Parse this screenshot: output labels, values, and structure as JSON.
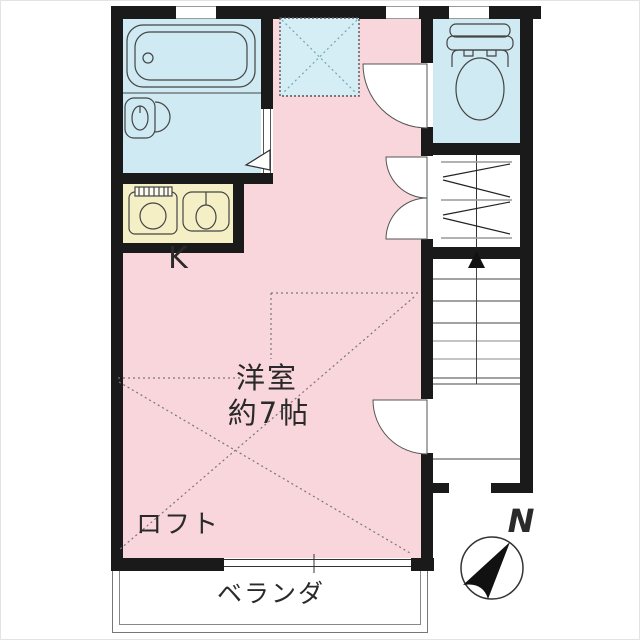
{
  "floorplan": {
    "labels": {
      "kitchen": "K",
      "room_name": "洋室",
      "room_size": "約7帖",
      "loft": "ロフト",
      "veranda": "ベランダ",
      "north": "N"
    },
    "colors": {
      "room_fill": "#f8d6dc",
      "wet_area_fill": "#cfeaf2",
      "kitchen_fill": "#f5efc5",
      "ladder_area_fill": "#d5edf4",
      "wall": "#1a1a1a"
    },
    "icons": [
      "bathtub-icon",
      "washbasin-icon",
      "stove-icon",
      "sink-icon",
      "toilet-icon",
      "closet-hatch-icon",
      "stairs-up-arrow-icon",
      "loft-ladder-area-icon",
      "door-swing-icon",
      "compass-icon"
    ]
  }
}
